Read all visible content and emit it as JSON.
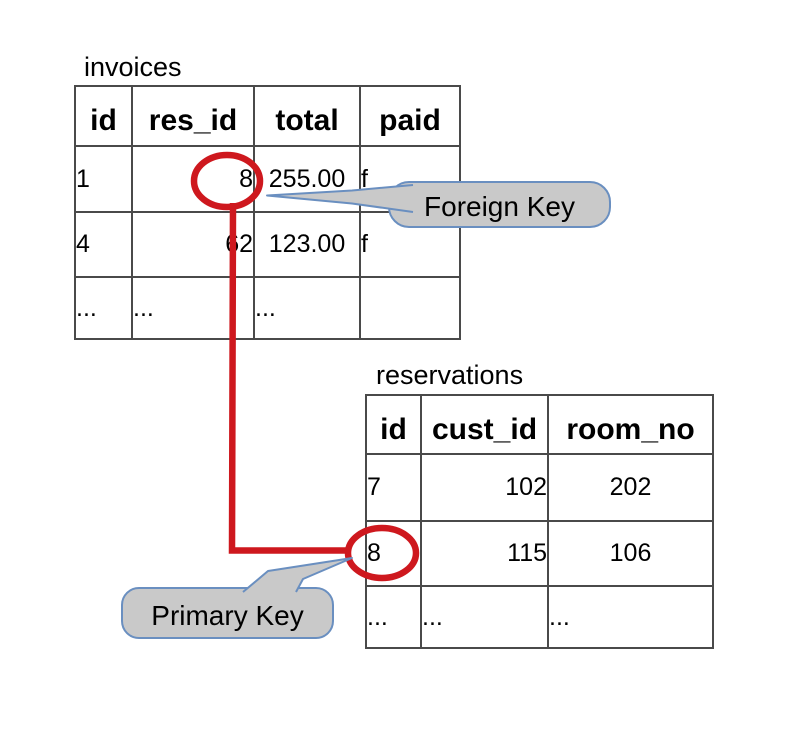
{
  "tables": {
    "invoices": {
      "title": "invoices",
      "headers": [
        "id",
        "res_id",
        "total",
        "paid"
      ],
      "rows": [
        [
          "1",
          "8",
          "255.00",
          "f"
        ],
        [
          "4",
          "62",
          "123.00",
          "f"
        ],
        [
          "...",
          "...",
          "...",
          ""
        ]
      ]
    },
    "reservations": {
      "title": "reservations",
      "headers": [
        "id",
        "cust_id",
        "room_no"
      ],
      "rows": [
        [
          "7",
          "102",
          "202"
        ],
        [
          "8",
          "115",
          "106"
        ],
        [
          "...",
          "...",
          "..."
        ]
      ]
    }
  },
  "callouts": {
    "foreign_key": "Foreign Key",
    "primary_key": "Primary Key"
  },
  "colors": {
    "highlight_red": "#ce181e",
    "callout_fill": "#c9c9c9",
    "callout_border": "#6a8fc0",
    "table_border": "#4a4a4a"
  }
}
